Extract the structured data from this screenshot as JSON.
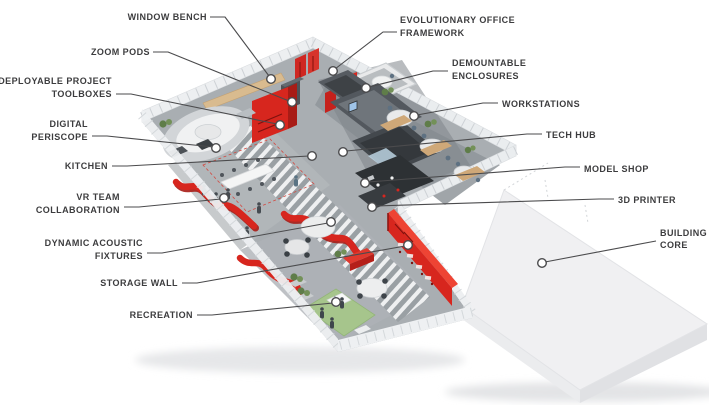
{
  "diagram": {
    "type": "isometric-office-floorplan-callout-diagram",
    "labels": [
      {
        "id": "window-bench",
        "side": "left",
        "lines": [
          "WINDOW BENCH"
        ]
      },
      {
        "id": "zoom-pods",
        "side": "left",
        "lines": [
          "ZOOM PODS"
        ]
      },
      {
        "id": "deployable-project-toolboxes",
        "side": "left",
        "lines": [
          "DEPLOYABLE PROJECT",
          "TOOLBOXES"
        ]
      },
      {
        "id": "digital-periscope",
        "side": "left",
        "lines": [
          "DIGITAL",
          "PERISCOPE"
        ]
      },
      {
        "id": "kitchen",
        "side": "left",
        "lines": [
          "KITCHEN"
        ]
      },
      {
        "id": "vr-team-collaboration",
        "side": "left",
        "lines": [
          "VR TEAM",
          "COLLABORATION"
        ]
      },
      {
        "id": "dynamic-acoustic-fixtures",
        "side": "left",
        "lines": [
          "DYNAMIC ACOUSTIC",
          "FIXTURES"
        ]
      },
      {
        "id": "storage-wall",
        "side": "left",
        "lines": [
          "STORAGE WALL"
        ]
      },
      {
        "id": "recreation",
        "side": "left",
        "lines": [
          "RECREATION"
        ]
      },
      {
        "id": "evolutionary-office-framework",
        "side": "right",
        "lines": [
          "EVOLUTIONARY OFFICE",
          "FRAMEWORK"
        ]
      },
      {
        "id": "demountable-enclosures",
        "side": "right",
        "lines": [
          "DEMOUNTABLE",
          "ENCLOSURES"
        ]
      },
      {
        "id": "workstations",
        "side": "right",
        "lines": [
          "WORKSTATIONS"
        ]
      },
      {
        "id": "tech-hub",
        "side": "right",
        "lines": [
          "TECH HUB"
        ]
      },
      {
        "id": "model-shop",
        "side": "right",
        "lines": [
          "MODEL SHOP"
        ]
      },
      {
        "id": "3d-printer",
        "side": "right",
        "lines": [
          "3D PRINTER"
        ]
      },
      {
        "id": "building-core",
        "side": "right",
        "lines": [
          "BUILDING",
          "CORE"
        ]
      }
    ],
    "colors": {
      "accent_red": "#d7261e",
      "accent_red_dark": "#a81c16",
      "label_text": "#3c3c3e",
      "leader_line": "#4b4b4d",
      "floor_gray": "#a9aeb2",
      "dark_room": "#4a4f54",
      "wood": "#d9bb8f",
      "recreation_green": "#a6c58c",
      "core_slab": "#f0f0f2",
      "glass_wall": "#edeff1"
    }
  }
}
